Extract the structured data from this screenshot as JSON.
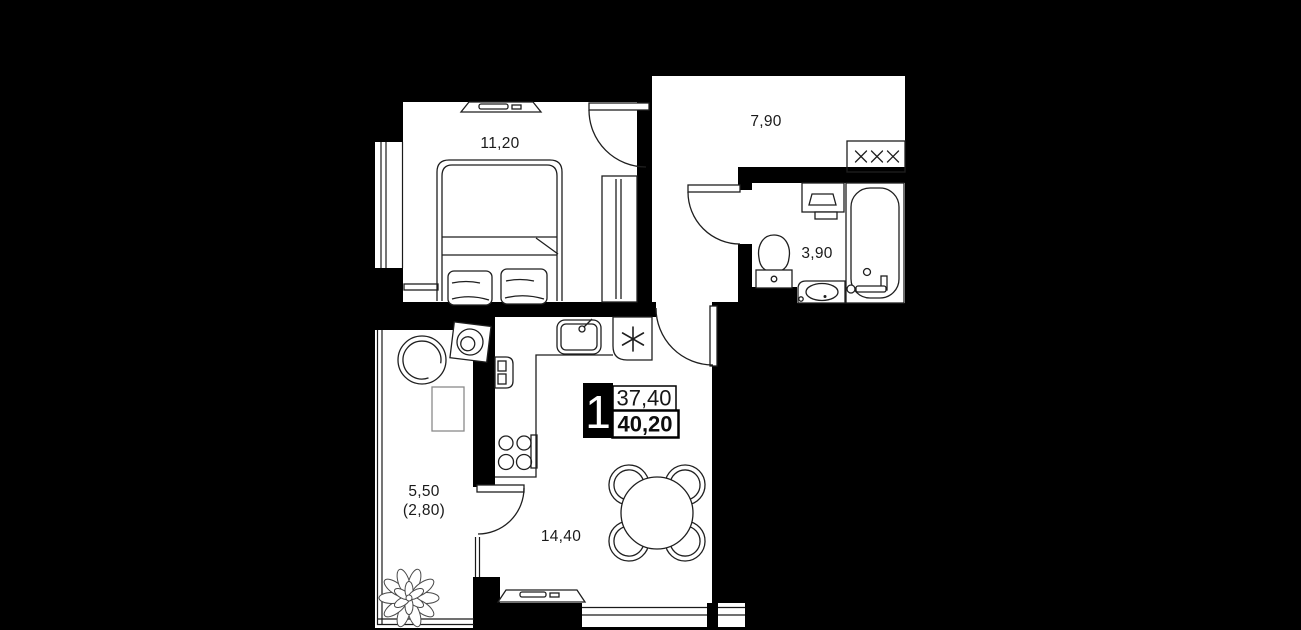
{
  "canvas": {
    "width": 1301,
    "height": 630
  },
  "colors": {
    "background": "#000000",
    "floor": "#ffffff",
    "wall": "#000000",
    "furniture_line": "#1f1f1f",
    "light_line": "#8a8a8a",
    "text": "#1a1a1a",
    "badge_bg": "#000000",
    "badge_text": "#ffffff"
  },
  "unit_badge": {
    "rooms_count": "1",
    "area_top": "37,40",
    "area_bottom": "40,20"
  },
  "rooms": [
    {
      "id": "bedroom",
      "area_label": "11,20"
    },
    {
      "id": "hallway",
      "area_label": "7,90"
    },
    {
      "id": "bathroom",
      "area_label": "3,90"
    },
    {
      "id": "kitchen_living_room",
      "area_label": "14,40"
    },
    {
      "id": "balcony",
      "area_label": "5,50",
      "area_label_secondary": "(2,80)"
    }
  ],
  "icons": {
    "fridge_icon": "six-spoke snowflake asterisk",
    "coat_rack_icon": "three x hooks"
  }
}
